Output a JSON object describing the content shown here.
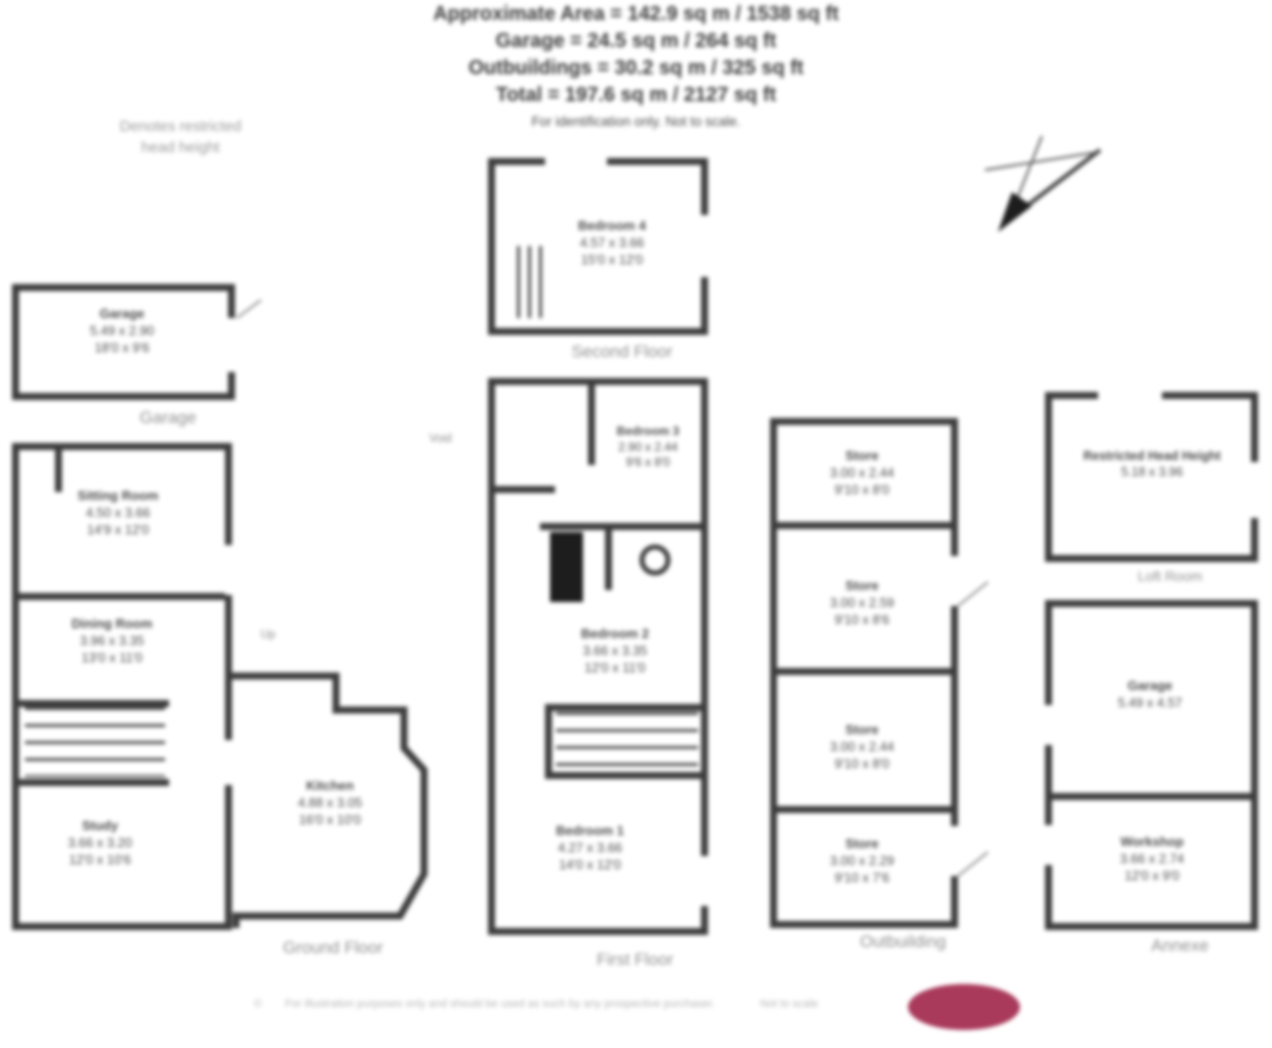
{
  "title": {
    "line1": "Approximate Area = 142.9 sq m / 1538 sq ft",
    "line2": "Garage = 24.5 sq m / 264 sq ft",
    "line3": "Outbuildings = 30.2 sq m / 325 sq ft",
    "line4": "Total = 197.6 sq m / 2127 sq ft",
    "line5": "For identification only. Not to scale."
  },
  "legend": {
    "line1": "Denotes restricted",
    "line2": "head height"
  },
  "icons": {
    "north_arrow": "compass-north-arrow"
  },
  "colors": {
    "wall": "#3c3c3c",
    "room_label": "#4a4a4a",
    "caption": "#8f8f8f",
    "logo": "#a93a5b"
  },
  "sections": {
    "garage": {
      "caption": "Garage",
      "rooms": [
        {
          "name": "Garage",
          "metric": "5.49 x 2.90",
          "imperial": "18'0 x 9'6"
        }
      ]
    },
    "ground_floor": {
      "caption": "Ground Floor",
      "up_label": "Up",
      "rooms": [
        {
          "name": "Sitting Room",
          "metric": "4.50 x 3.66",
          "imperial": "14'9 x 12'0"
        },
        {
          "name": "Dining Room",
          "metric": "3.96 x 3.35",
          "imperial": "13'0 x 11'0"
        },
        {
          "name": "Study",
          "metric": "3.66 x 3.20",
          "imperial": "12'0 x 10'6"
        },
        {
          "name": "Kitchen",
          "metric": "4.88 x 3.05",
          "imperial": "16'0 x 10'0"
        }
      ]
    },
    "second_floor": {
      "caption": "Second Floor",
      "rooms": [
        {
          "name": "Bedroom 4",
          "metric": "4.57 x 3.66",
          "imperial": "15'0 x 12'0"
        }
      ]
    },
    "first_floor": {
      "caption": "First Floor",
      "void_label": "Void",
      "rooms": [
        {
          "name": "Bedroom 3",
          "metric": "2.90 x 2.44",
          "imperial": "9'6 x 8'0"
        },
        {
          "name": "Bedroom 2",
          "metric": "3.66 x 3.35",
          "imperial": "12'0 x 11'0"
        },
        {
          "name": "Bedroom 1",
          "metric": "4.27 x 3.66",
          "imperial": "14'0 x 12'0"
        }
      ]
    },
    "outbuilding": {
      "caption": "Outbuilding",
      "rooms": [
        {
          "name": "Store",
          "metric": "3.00 x 2.44",
          "imperial": "9'10 x 8'0"
        },
        {
          "name": "Store",
          "metric": "3.00 x 2.59",
          "imperial": "9'10 x 8'6"
        },
        {
          "name": "Store",
          "metric": "3.00 x 2.44",
          "imperial": "9'10 x 8'0"
        },
        {
          "name": "Store",
          "metric": "3.00 x 2.29",
          "imperial": "9'10 x 7'6"
        }
      ]
    },
    "loft": {
      "caption": "Loft Room",
      "rooms": [
        {
          "name": "Restricted Head Height",
          "metric": "5.18 x 3.96",
          "imperial": "17'0 x 13'0"
        }
      ]
    },
    "annexe": {
      "caption": "Annexe",
      "rooms": [
        {
          "name": "Garage",
          "metric": "5.49 x 4.57",
          "imperial": "18'0 x 15'0"
        },
        {
          "name": "Workshop",
          "metric": "3.66 x 2.74",
          "imperial": "12'0 x 9'0"
        }
      ]
    }
  },
  "footer": {
    "copyright": "©",
    "disclaimer": "For illustration purposes only and should be used as such by any prospective purchaser.",
    "scale_note": "Not to scale",
    "logo_color": "#a93a5b"
  }
}
